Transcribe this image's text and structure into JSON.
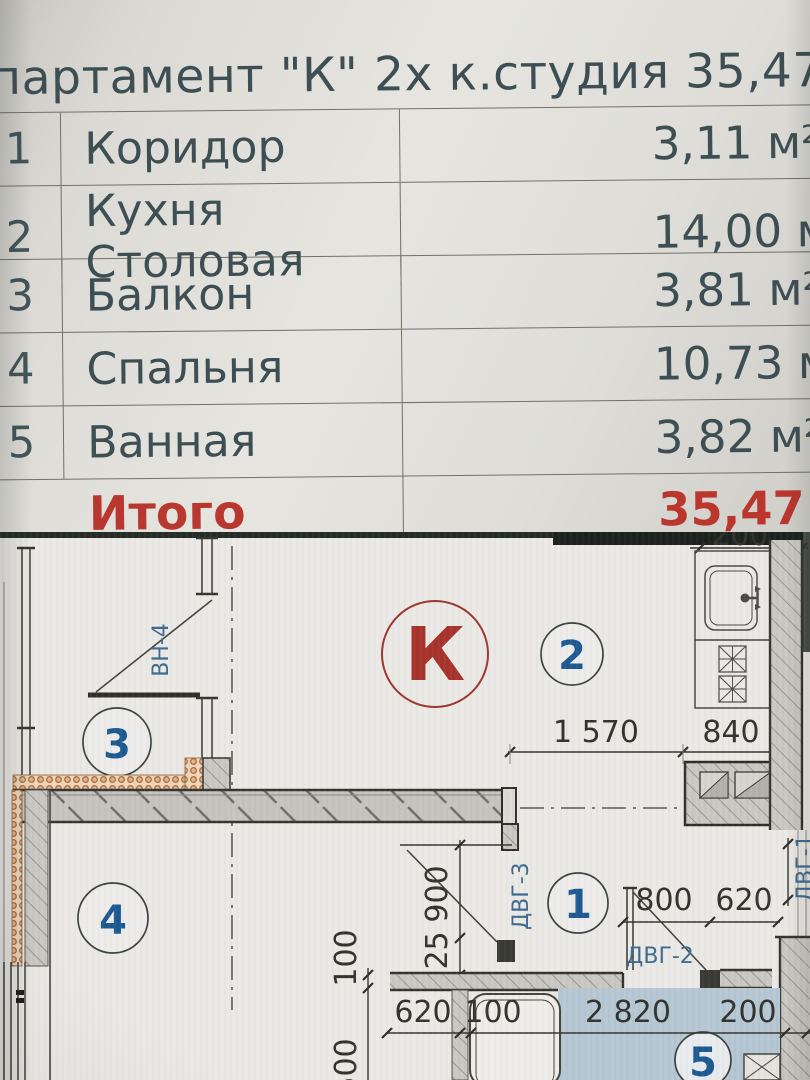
{
  "table": {
    "title": "партамент \"К\" 2х к.студия 35,47 м2",
    "rows": [
      {
        "num": "1",
        "name": "Коридор",
        "area": "3,11 м²"
      },
      {
        "num": "2",
        "name": "Кухня Столовая",
        "area": "14,00 м"
      },
      {
        "num": "3",
        "name": "Балкон",
        "area": "3,81 м²"
      },
      {
        "num": "4",
        "name": "Спальня",
        "area": "10,73 м"
      },
      {
        "num": "5",
        "name": "Ванная",
        "area": "3,82 м²"
      }
    ],
    "total": {
      "label": "Итого",
      "value": "35,47 м"
    }
  },
  "plan": {
    "unit_letter": "К",
    "markers": {
      "m1": "1",
      "m2": "2",
      "m3": "3",
      "m4": "4",
      "m5": "5"
    },
    "labels": {
      "window": "ВН-4",
      "door3": "ДВГ-3",
      "door2": "ДВГ-2",
      "door1": "ДВГ-1"
    },
    "dims": {
      "kitchen_width": "1 570",
      "kitchen_niche": "840",
      "hall_door": "800",
      "hall_wall": "620",
      "bath_left": "620",
      "bath_gap": "100",
      "bath_width": "2 820",
      "bath_right": "200",
      "left_100": "100",
      "left_500": "500",
      "door_900": "900",
      "door_225": "225",
      "top_right_partial": "200"
    }
  },
  "colors": {
    "accent_red": "#b8372e",
    "marker_blue": "#1d5a92",
    "label_blue": "#3f6b90",
    "bath_floor": "#b6c8d4",
    "table_text": "#3e4f53"
  }
}
